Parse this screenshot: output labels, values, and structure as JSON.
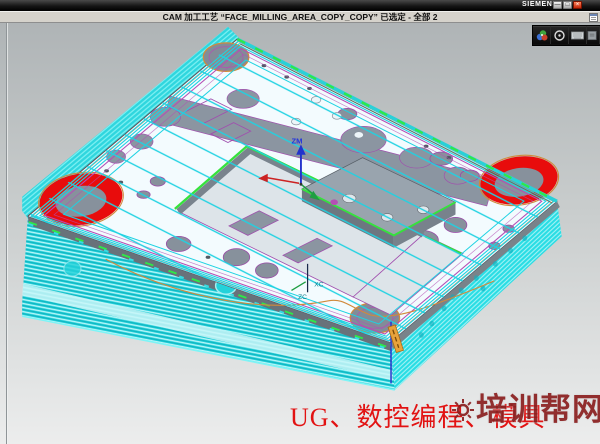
{
  "window": {
    "brand": "SIEMENS",
    "buttons": [
      {
        "name": "minimize-button",
        "glyph": "—"
      },
      {
        "name": "restore-button",
        "glyph": "□"
      },
      {
        "name": "close-button",
        "glyph": "×"
      }
    ]
  },
  "prompt_bar": {
    "message": "CAM 加工工艺 “FACE_MILLING_AREA_COPY_COPY” 已选定 - 全部 2"
  },
  "mini_toolbar": {
    "icons": [
      "shaded-display-icon",
      "snap-circle-icon",
      "keyboard-icon",
      "panel-icon"
    ]
  },
  "wcs": {
    "zm": "ZM",
    "xc": "XC",
    "zc": "ZC"
  },
  "overlay": {
    "caption": "UG、数控编程、模具",
    "watermark": "培训帮网"
  },
  "colors": {
    "toolpath_cyan": "#1fd2e2",
    "side_cyan": "#1fced8",
    "highlight_red": "#e80c0c",
    "rim_green": "#35e23c",
    "boundary_magenta": "#b44fb4",
    "pocket_gray": "#8b95a1",
    "caption_red": "#e21313",
    "watermark_maroon": "#8b2020"
  }
}
